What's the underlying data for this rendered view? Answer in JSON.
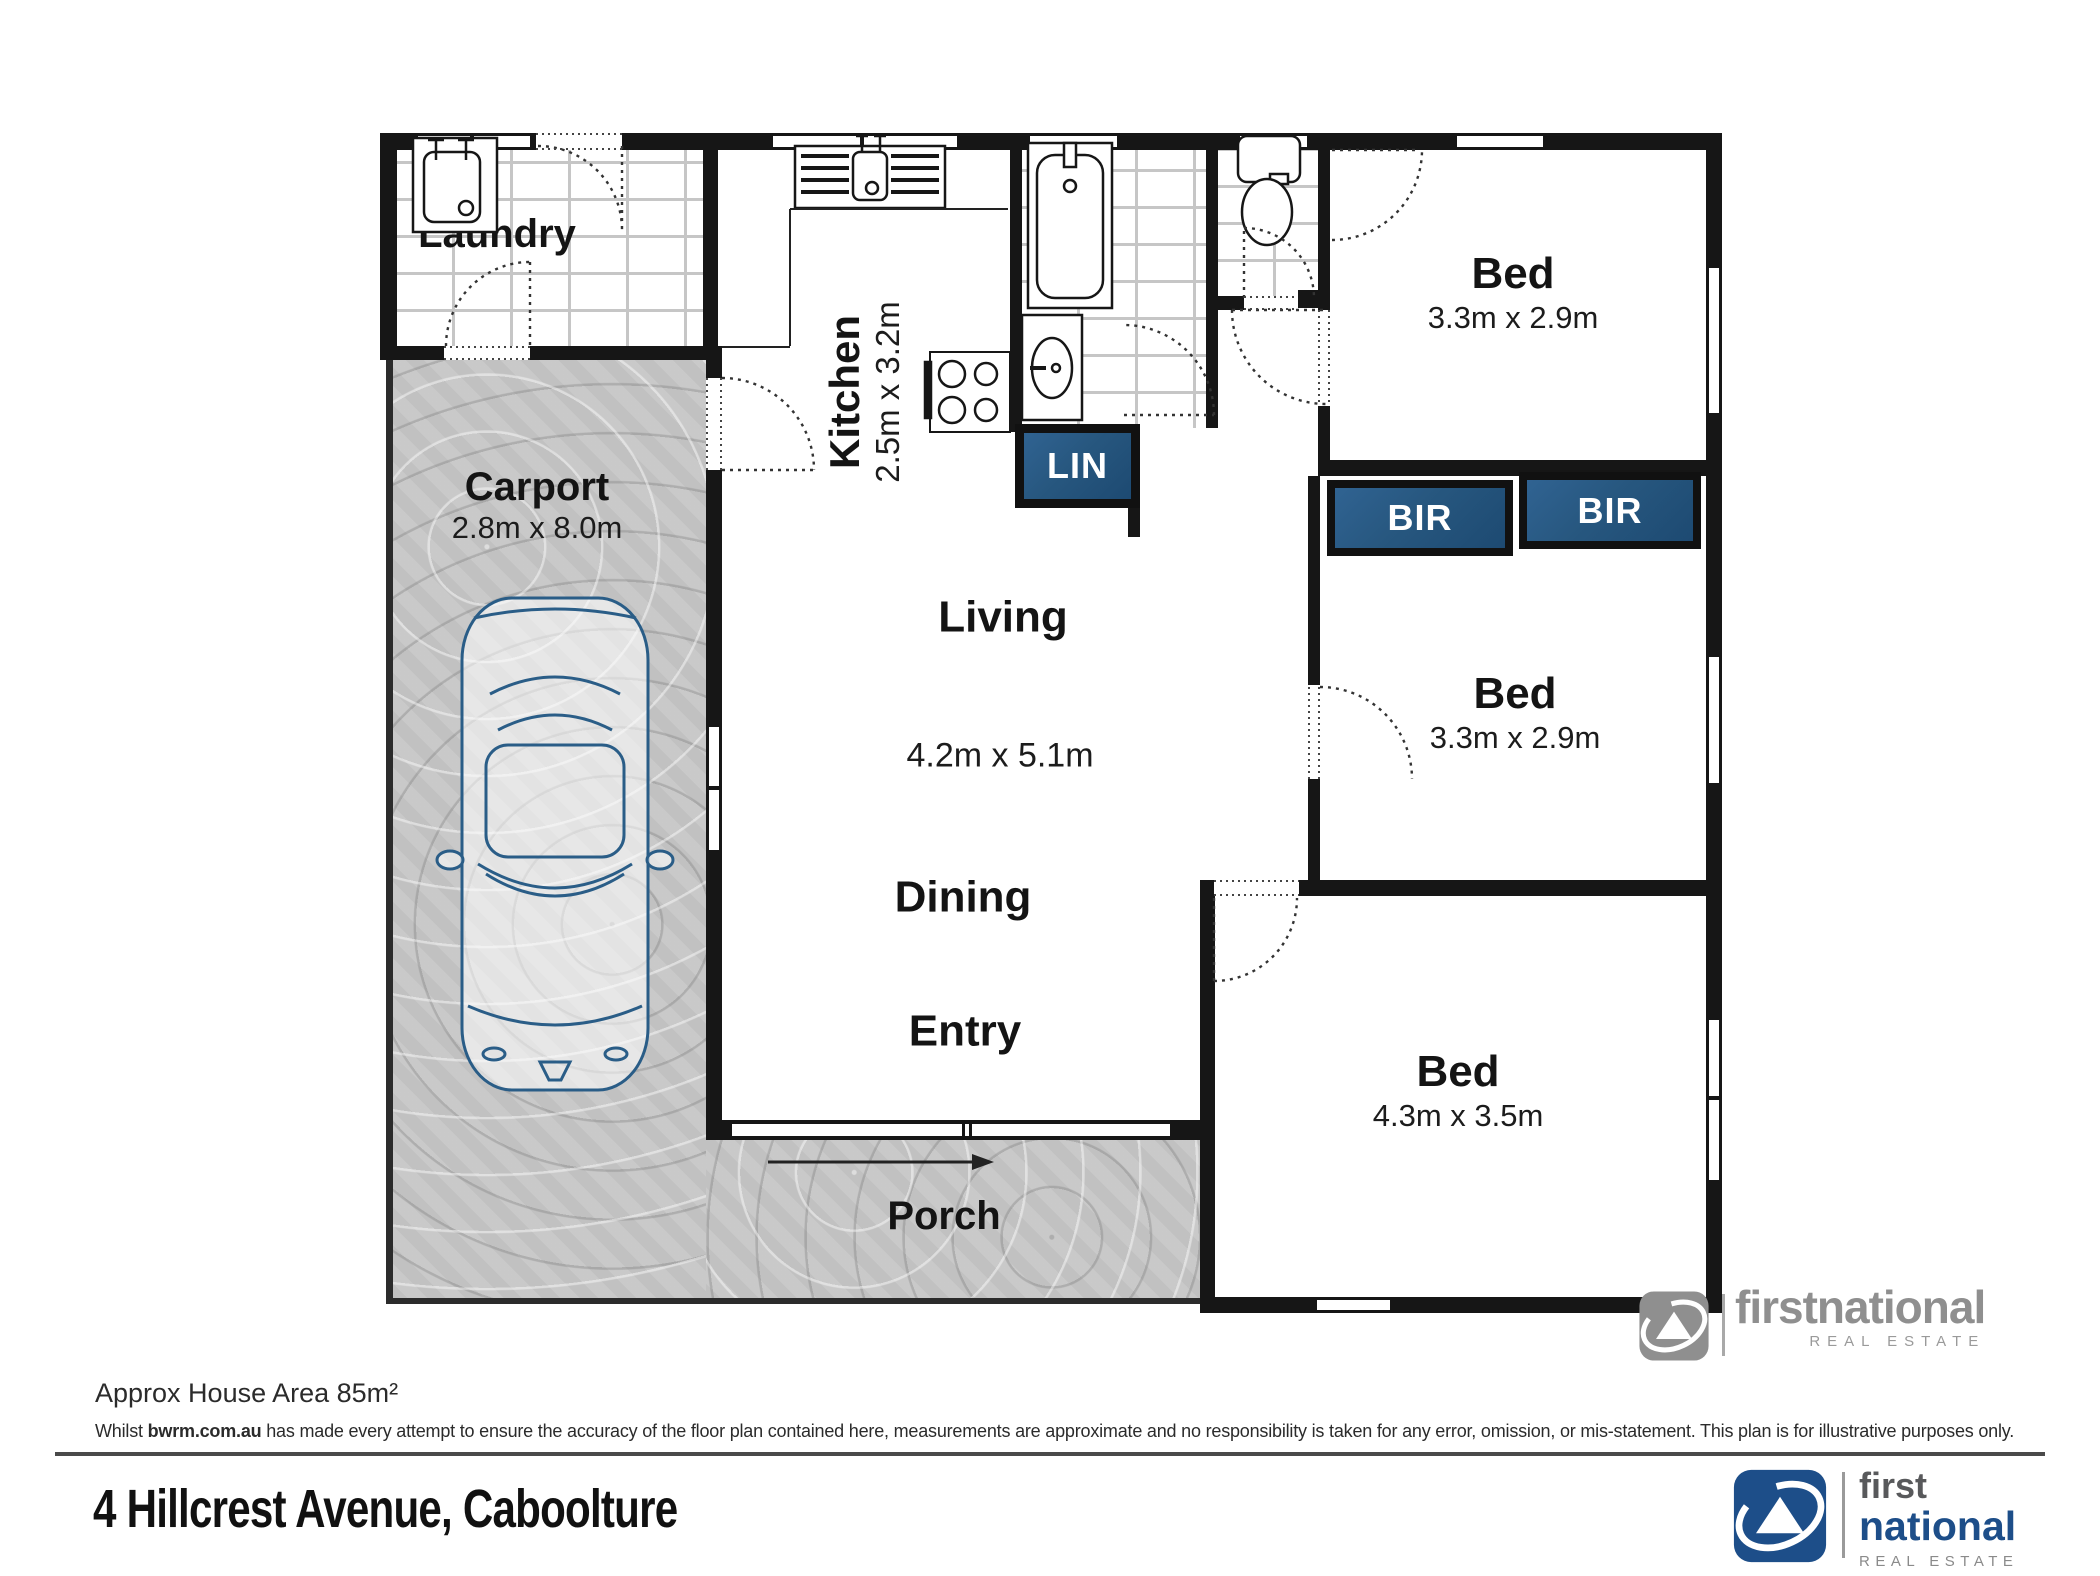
{
  "plan": {
    "rooms": {
      "laundry": {
        "label": "Laundry"
      },
      "carport": {
        "label": "Carport",
        "dims": "2.8m x 8.0m"
      },
      "kitchen": {
        "label": "Kitchen",
        "dims": "2.5m x 3.2m"
      },
      "living": {
        "label": "Living",
        "dims": "4.2m x 5.1m"
      },
      "dining": {
        "label": "Dining"
      },
      "entry": {
        "label": "Entry"
      },
      "porch": {
        "label": "Porch"
      },
      "bed1": {
        "label": "Bed",
        "dims": "3.3m x 2.9m"
      },
      "bed2": {
        "label": "Bed",
        "dims": "3.3m x 2.9m"
      },
      "bed3": {
        "label": "Bed",
        "dims": "4.3m x 3.5m"
      }
    },
    "closets": {
      "lin": "LIN",
      "bir_left": "BIR",
      "bir_right": "BIR"
    },
    "fixtures": [
      "laundry-tub",
      "kitchen-sink",
      "stove",
      "bathtub",
      "vanity-basin",
      "toilet",
      "car"
    ]
  },
  "watermark": {
    "first": "first",
    "national": "national",
    "tagline": "REAL ESTATE"
  },
  "footer": {
    "area_note": "Approx House Area 85m²",
    "disclaimer_prefix": "Whilst ",
    "disclaimer_site": "bwrm.com.au",
    "disclaimer_rest": " has made every attempt to ensure the accuracy of the floor plan contained here, measurements are approximate and no responsibility is taken for any error, omission, or mis-statement. This plan is for illustrative purposes only.",
    "address": "4 Hillcrest Avenue, Caboolture",
    "logo": {
      "first": "first",
      "national": "national",
      "tagline": "REAL ESTATE"
    }
  },
  "colors": {
    "closet_blue": "#27577f",
    "logo_blue": "#1d4e89",
    "wall": "#161616",
    "watermark_gray": "#8f8f8f"
  }
}
